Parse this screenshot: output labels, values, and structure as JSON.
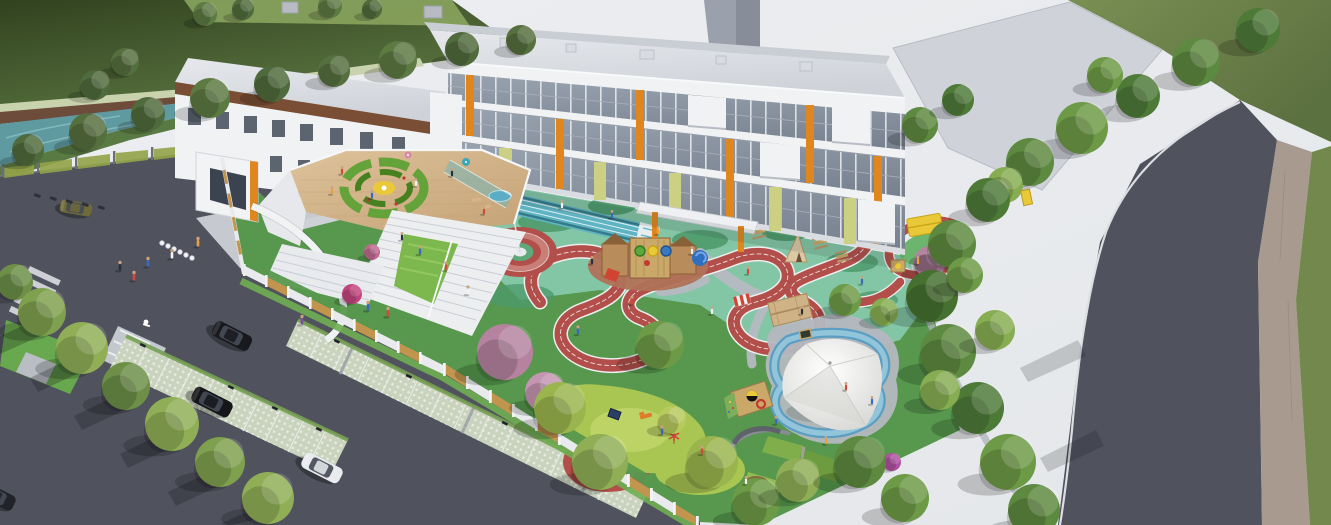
{
  "meta": {
    "title": "Aerial architectural rendering of a kindergarten campus",
    "type": "3d-architectural-render",
    "view": "high oblique aerial",
    "visible_text": []
  },
  "scene": {
    "areas": [
      {
        "name": "main-building",
        "desc": "three-storey white school building with glass curtain walls, orange and yellow-green accent panels"
      },
      {
        "name": "left-wing",
        "desc": "wing with brown fascia band, punched windows and white entrance portal"
      },
      {
        "name": "background-tower",
        "desc": "tall grey tower behind the school"
      },
      {
        "name": "rooftop-terrace",
        "desc": "timber deck terrace with circular green play maze and yellow centre canopy"
      },
      {
        "name": "grand-stairs",
        "desc": "white amphitheater stairs with planted green slope"
      },
      {
        "name": "courtyard-playground",
        "desc": "seafoam play court with teal sprint lanes, flag plaza of concentric red rings"
      },
      {
        "name": "red-running-track",
        "desc": "winding red rubber track with white lane lines looping through the playground"
      },
      {
        "name": "adventure-playground",
        "desc": "wooden play fort with slides, teepee, picnic tables, cabin, striped kiosk, climbing cube"
      },
      {
        "name": "sand-and-water-play",
        "desc": "white tensile canopy over a sand pit with tyres, ringed by a blue water channel"
      },
      {
        "name": "garden-terraces",
        "desc": "curved planting terraces, arc bench and round timber planter"
      },
      {
        "name": "mini-oval-track",
        "desc": "small red oval track with yellow shade pavilion"
      },
      {
        "name": "parking-lot",
        "desc": "grass-paver parking bays, accessible stall, crosswalk, median island and cars"
      },
      {
        "name": "boundary-fence",
        "desc": "white fence with timber slat infill panels around the site"
      },
      {
        "name": "canal",
        "desc": "teal waterway with brown embankment and a row of trees"
      },
      {
        "name": "perimeter-road",
        "desc": "curved dark asphalt road with white edge line and paved sidewalk"
      }
    ],
    "counts": {
      "cars": 5,
      "flags": 1,
      "tensile_canopies": 1
    }
  },
  "palette": {
    "sky": "#eaecef",
    "field": "#55693b",
    "field_dark": "#32421f",
    "field_right": "#72884c",
    "hedge": "#8aa45e",
    "water": "#5f9aa1",
    "water_light": "#8abfc2",
    "embankment": "#6e4c3b",
    "path_strip": "#c8d2ac",
    "road": "#50525e",
    "plaza": "#c6c9cf",
    "plaza_top": "#cfd3d9",
    "sidewalk": "#a89a8e",
    "edge_line": "#dcdee2",
    "stall_paver": "#c9d3bd",
    "stall_grass": "#76a054",
    "fence_wood": "#c2954f",
    "fence_white": "#e9eaed",
    "fence_mesh": "#93a348",
    "building": "#f0f2f4",
    "building_shade": "#d9dce1",
    "roof": "#dde0e4",
    "roof_back": "#c9cdd4",
    "glass": "#8d97a4",
    "mullion": "#eef0f3",
    "brown_band": "#7a4e34",
    "orange": "#e0861f",
    "yellow_green": "#ccd083",
    "yellow": "#e9c938",
    "court": "#83c6a6",
    "mound": "#4e9a6c",
    "lawn": "#57984e",
    "lawn_bright": "#a9c653",
    "lawn_bright2": "#c2d66a",
    "teal_track": "#5eb4c2",
    "teal_dark": "#2f6f7d",
    "track_red": "#b24f4a",
    "track_red_light": "#c97f78",
    "track_white": "#eceeef",
    "deck": "#d7b88d",
    "maze_green": "#64a23a",
    "maze_dark": "#46801f",
    "sand": "#e0cda6",
    "water_play": "#5b9ec2",
    "water_play_light": "#9ccade",
    "canopy": "#f6f6f4",
    "canopy_shade": "#d5d6d2",
    "wood": "#caa86a",
    "wood_dark": "#8a6137",
    "blossom": "#b583a0",
    "blossom_light": "#c495b2",
    "magenta": "#c2447e",
    "flag": "#d8372a",
    "tree_dark": "#4e7a38",
    "tree": "#5d8a40",
    "tree_mid": "#6d9a46",
    "tree_light": "#87ad52",
    "tree_yellow": "#9ab54e",
    "olive_tree": "#4f6a3c",
    "car_black": "#17191d",
    "car_white": "#e9ebee",
    "car_olive": "#6e6a3a",
    "person_red": "#d04a3a",
    "person_blue": "#3a6ac0",
    "person_white": "#f2f2f2",
    "person_dark": "#26303e",
    "person_orange": "#e8a23a",
    "person_purple": "#7a4ea0"
  }
}
